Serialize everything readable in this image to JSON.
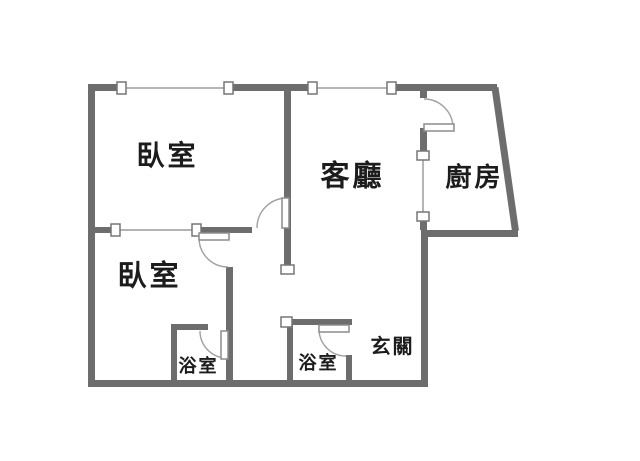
{
  "plan": {
    "type": "floor-plan",
    "background_color": "#ffffff",
    "wall_color": "#6d6d6d",
    "text_color": "#1c1c1c",
    "rooms": [
      {
        "name": "bedroom-1",
        "label": "臥室"
      },
      {
        "name": "living-room",
        "label": "客廳"
      },
      {
        "name": "kitchen",
        "label": "廚房"
      },
      {
        "name": "bedroom-2",
        "label": "臥室"
      },
      {
        "name": "bathroom-1",
        "label": "浴室"
      },
      {
        "name": "bathroom-2",
        "label": "浴室"
      },
      {
        "name": "entry-hall",
        "label": "玄關"
      }
    ],
    "doors": [
      {
        "name": "kitchen-door"
      },
      {
        "name": "bedroom-1-door"
      },
      {
        "name": "bedroom-2-door"
      },
      {
        "name": "bathroom-1-door"
      },
      {
        "name": "bathroom-2-door"
      }
    ],
    "windows": [
      {
        "name": "bedroom-1-top-window"
      },
      {
        "name": "living-room-top-window"
      },
      {
        "name": "bedroom-divider-window"
      },
      {
        "name": "kitchen-wall-window"
      }
    ]
  }
}
